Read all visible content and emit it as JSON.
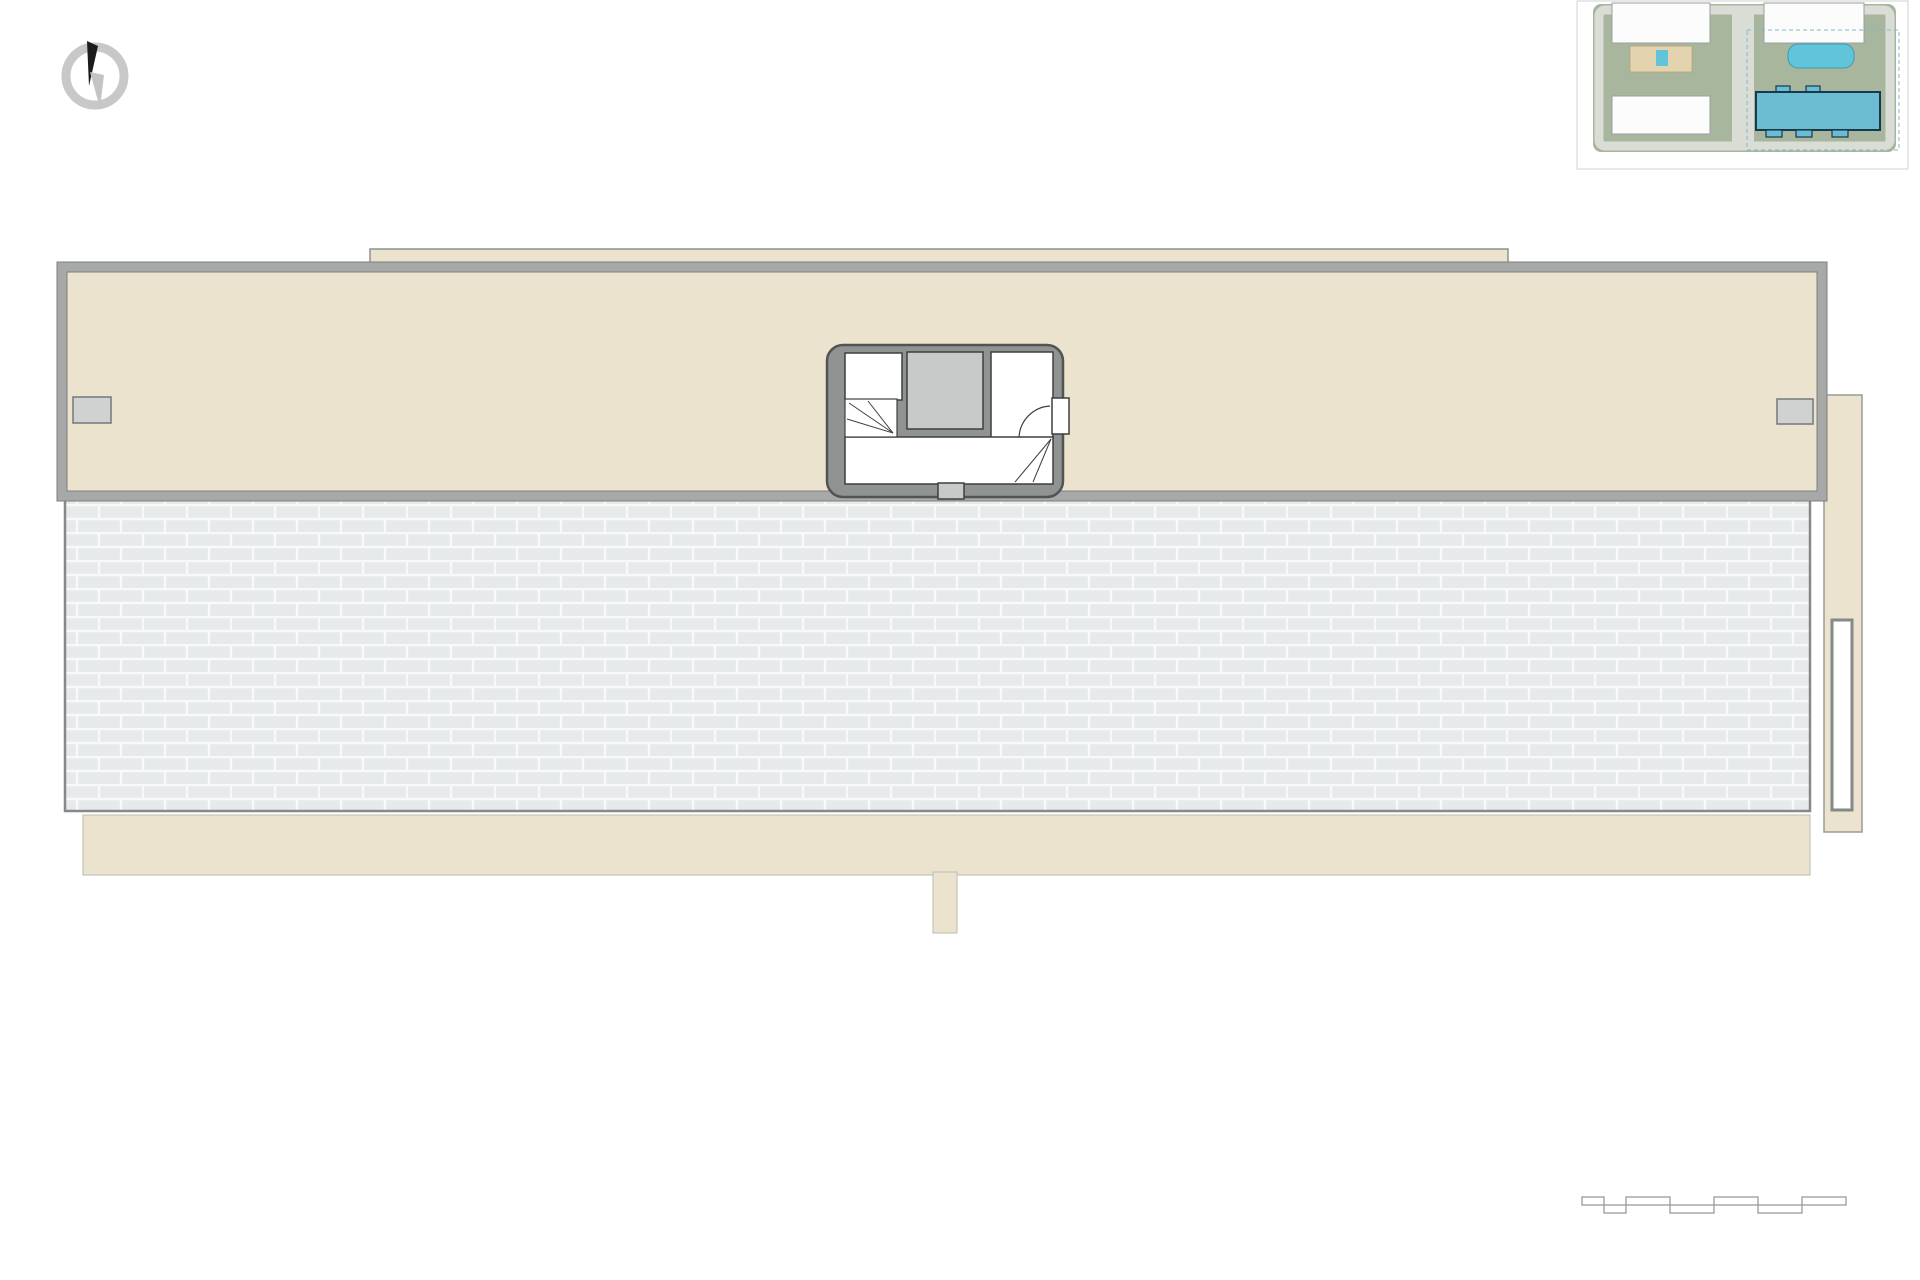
{
  "compass": {
    "label": "N"
  },
  "site_plan": {
    "caption": "BLOQUE 1 - Solarium",
    "fase_label": "FASE 1",
    "street_bottom": "Calle / Street Mayor",
    "street_left": "Calle / Street",
    "street_right": "Calle / Street"
  },
  "plan": {
    "stair_core_area_label": "1,50m²",
    "units": [
      {
        "id": "18",
        "number_label": "Nº 18",
        "area_label": "43,98m²",
        "stair_area_label": "3,85m²"
      },
      {
        "id": "17",
        "number_label": "Nº 17",
        "area_label": "45,22m²",
        "stair_area_label": "3,85m²"
      },
      {
        "id": "16",
        "number_label": "Nº 16",
        "area_label": "45,22m²",
        "stair_area_label": "3,85m²"
      },
      {
        "id": "15",
        "number_label": "Nº 15",
        "area_label": "45,22m²",
        "stair_area_label": "3,85m²"
      },
      {
        "id": "14",
        "number_label": "Nº 14",
        "area_label": "45,22m²",
        "stair_area_label": "3,85m²"
      },
      {
        "id": "13",
        "number_label": "Nº 13",
        "area_label": "43,98m²",
        "stair_area_label": "3,85m²"
      }
    ]
  },
  "summary": {
    "columns": [
      {
        "title": "Vivienda Nº18",
        "row_label": "Solarium",
        "row_value": "43,98 m²"
      },
      {
        "title": "Vivienda Nº17",
        "row_label": "Solarium",
        "row_value": "45,22 m²"
      },
      {
        "title": "Vivienda Nº16",
        "row_label": "Solarium",
        "row_value": "45,22 m²"
      },
      {
        "title": "Vivienda Nº15",
        "row_label": "Solarium",
        "row_value": "45,22 m²"
      },
      {
        "title": "Vivienda Nº14",
        "row_label": "Solarium",
        "row_value": "45,22 m²"
      },
      {
        "title": "Vivienda Nº13",
        "row_label": "Solarium",
        "row_value": "43,98 m²"
      }
    ]
  },
  "scale_bar": {
    "label": "Escala / Scale",
    "top_numbers": [
      "1",
      "3",
      "5"
    ],
    "bottom_numbers": [
      "0",
      "2",
      "4",
      "6"
    ]
  },
  "colors": {
    "deck_beige": "#ece3ce",
    "sunbed_blue": "#cfeefb",
    "terrace_grey": "#e7eaea",
    "wall_grey": "#a6a9a8",
    "stairwell_grey": "#8f9392",
    "separator_teal": "#7ab9c5",
    "pool_blue": "#62c4d8",
    "bloque_teal": "#6dbdd2"
  }
}
